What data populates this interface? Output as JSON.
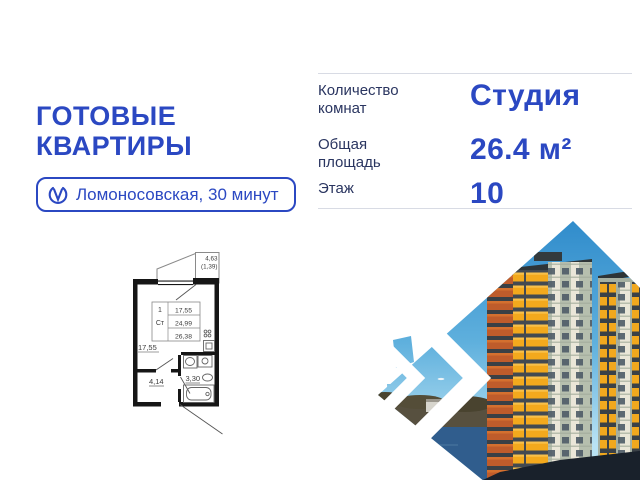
{
  "header": {
    "title_line1": "ГОТОВЫЕ",
    "title_line2": "КВАРТИРЫ",
    "metro_badge": {
      "station": "Ломоносовская, 30 минут"
    }
  },
  "specs": {
    "rows": [
      {
        "label_line1": "Количество",
        "label_line2": "комнат",
        "value": "Студия"
      },
      {
        "label_line1": "Общая",
        "label_line2": "площадь",
        "value": "26.4 м²"
      },
      {
        "label_line1": "Этаж",
        "label_line2": "",
        "value": "10"
      }
    ]
  },
  "floorplan": {
    "balcony_area": "4,63",
    "balcony_area_reduced": "(1,39)",
    "unit_table": {
      "rooms_count": "1",
      "unit_type": "Ст",
      "living_area": "17,55",
      "usable_area": "24,99",
      "total_area": "26,38"
    },
    "room_area": "17,55",
    "hallway_area": "4,14",
    "bathroom_area": "3,30"
  },
  "colors": {
    "accent_blue": "#2B48C2",
    "label_navy": "#2A3560",
    "divider_gray": "#D8DBE4",
    "balcony_yellow": "#F3A91D",
    "balcony_orange": "#BF5C2B",
    "sky_top": "#2F8BCB",
    "water_blue": "#305D8D"
  }
}
